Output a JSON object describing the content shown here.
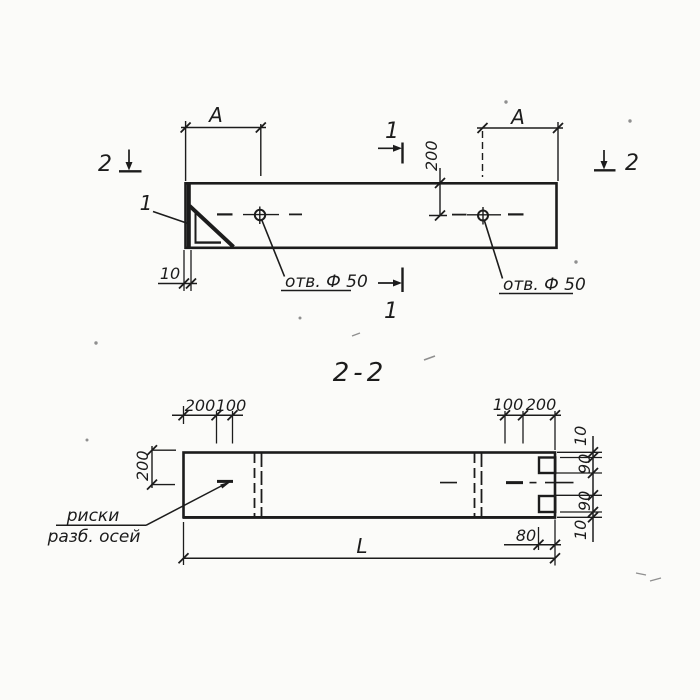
{
  "colors": {
    "ink": "#1c1c1c",
    "paper": "#fbfbf9",
    "speck": "#8f8f8f"
  },
  "plan_view": {
    "dim_a_left": "A",
    "dim_a_right": "A",
    "dim_axis_offset": "200",
    "dim_end_plate": "10",
    "hole_label_left": "отв. Ф 50",
    "hole_label_right": "отв. Ф 50",
    "detail_mark": "1",
    "section_mark_1_top": "1",
    "section_mark_1_bottom": "1",
    "section_mark_2_left": "2",
    "section_mark_2_right": "2"
  },
  "section_view": {
    "title": "2-2",
    "dim_axis_offset": "200",
    "dim_top_left_200": "200",
    "dim_top_left_100": "100",
    "dim_top_right_100": "100",
    "dim_top_right_200": "200",
    "dim_right_10_top": "10",
    "dim_right_90_top": "90",
    "dim_right_90_bottom": "90",
    "dim_right_10_bottom": "10",
    "dim_notch_depth": "80",
    "dim_length": "L",
    "axis_label_line1": "риски",
    "axis_label_line2": "разб. осей"
  }
}
